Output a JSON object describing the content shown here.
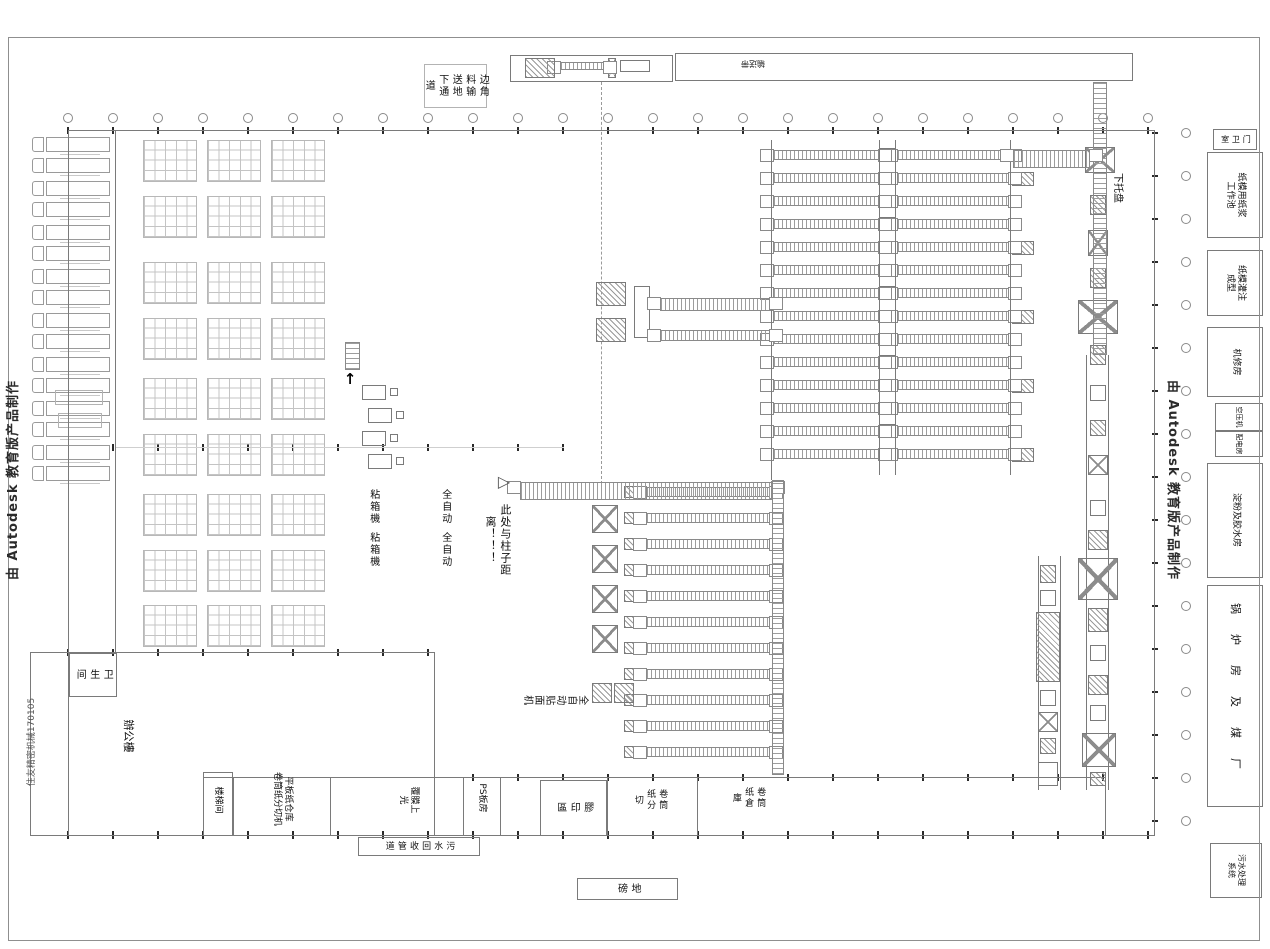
{
  "watermark": {
    "left": "由 Autodesk 教育版产品制作",
    "right": "由 Autodesk 教育版产品制作"
  },
  "drawing_number": "住友精密机械170105",
  "top_area": {
    "scrap_tunnel": "边角料输送地下通道",
    "conveyor_strip": "输送带",
    "pallet_down": "下托盘"
  },
  "annotations": {
    "column_note": "此处与柱子距离！！！"
  },
  "machine_labels": {
    "gluer_col_right": "全自动",
    "gluer_col_left": "粘箱機",
    "laminator": "全自动贴面机"
  },
  "left_wing": {
    "toilet": "卫生间",
    "office": "辦公樓",
    "stairwell": "楼梯间"
  },
  "bottom_rooms": {
    "flat_paper": "平板纸仓库\n卷筒纸分切机",
    "coating": "覆膜上光",
    "ps_room": "PS板房",
    "offset_print": "膠印區",
    "roll_slitting": "卷筒纸分切",
    "roll_warehouse": "卷筒纸倉庫",
    "sewage_pipe": "污水回收管道",
    "weighbridge": "地磅"
  },
  "right_rooms": {
    "gate_house": "门卫室",
    "pulp_pool": "纸模用纸浆\n工作池",
    "molding": "纸模灌注\n成型",
    "machine_repair": "机修房",
    "air_compressor": "空压机",
    "power_room": "配电房",
    "starch_glue": "淀粉及胶水房",
    "boiler_coal": "锅炉房及煤厂",
    "sewage_treatment": "污水处理\n系统"
  },
  "icons": {
    "triangle_marker": "▷",
    "up_arrow": "↑"
  },
  "colors": {
    "line": "#7a7a7a",
    "background": "#ffffff",
    "text": "#101010"
  }
}
